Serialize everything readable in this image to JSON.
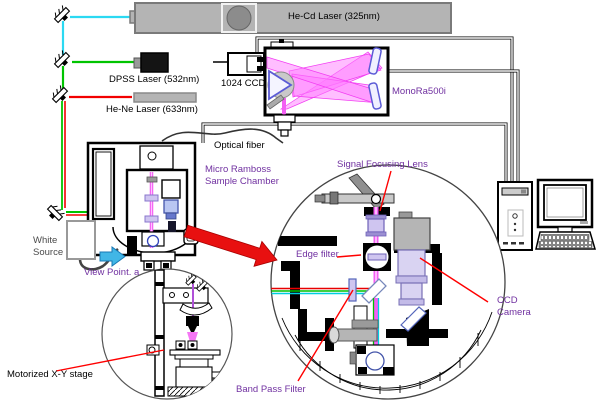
{
  "diagram": {
    "type": "raman-spectroscopy-system-schematic",
    "labels": {
      "he_cd_laser": "He-Cd Laser (325nm)",
      "dpss_laser": "DPSS Laser (532nm)",
      "he_ne_laser": "He-Ne Laser (633nm)",
      "ccd_1024": "1024 CCD",
      "monora": "MonoRa500i",
      "optical_fiber": "Optical fiber",
      "chamber_line1": "Micro Ramboss",
      "chamber_line2": "Sample Chamber",
      "white_source_line1": "White",
      "white_source_line2": "Source",
      "view_point": "View Point. a",
      "motorized_stage": "Motorized X-Y stage",
      "signal_lens": "Signal Focusing Lens",
      "edge_filter": "Edge filter",
      "ccd_camera_line1": "CCD",
      "ccd_camera_line2": "Camera",
      "band_pass": "Band Pass Filter"
    },
    "colors": {
      "beam_uv_cyan": "#2bd9f2",
      "beam_green": "#00c400",
      "beam_red": "#f20000",
      "beam_raman_magenta": "#f35ef3",
      "label_purple": "#7030a0",
      "pointer_red": "#ff0000",
      "big_arrow_red": "#e81010",
      "view_arrow_blue": "#41b6e6",
      "optic_lavender": "#cfc5f0",
      "laser_box_gray": "#b4b4b4"
    }
  }
}
